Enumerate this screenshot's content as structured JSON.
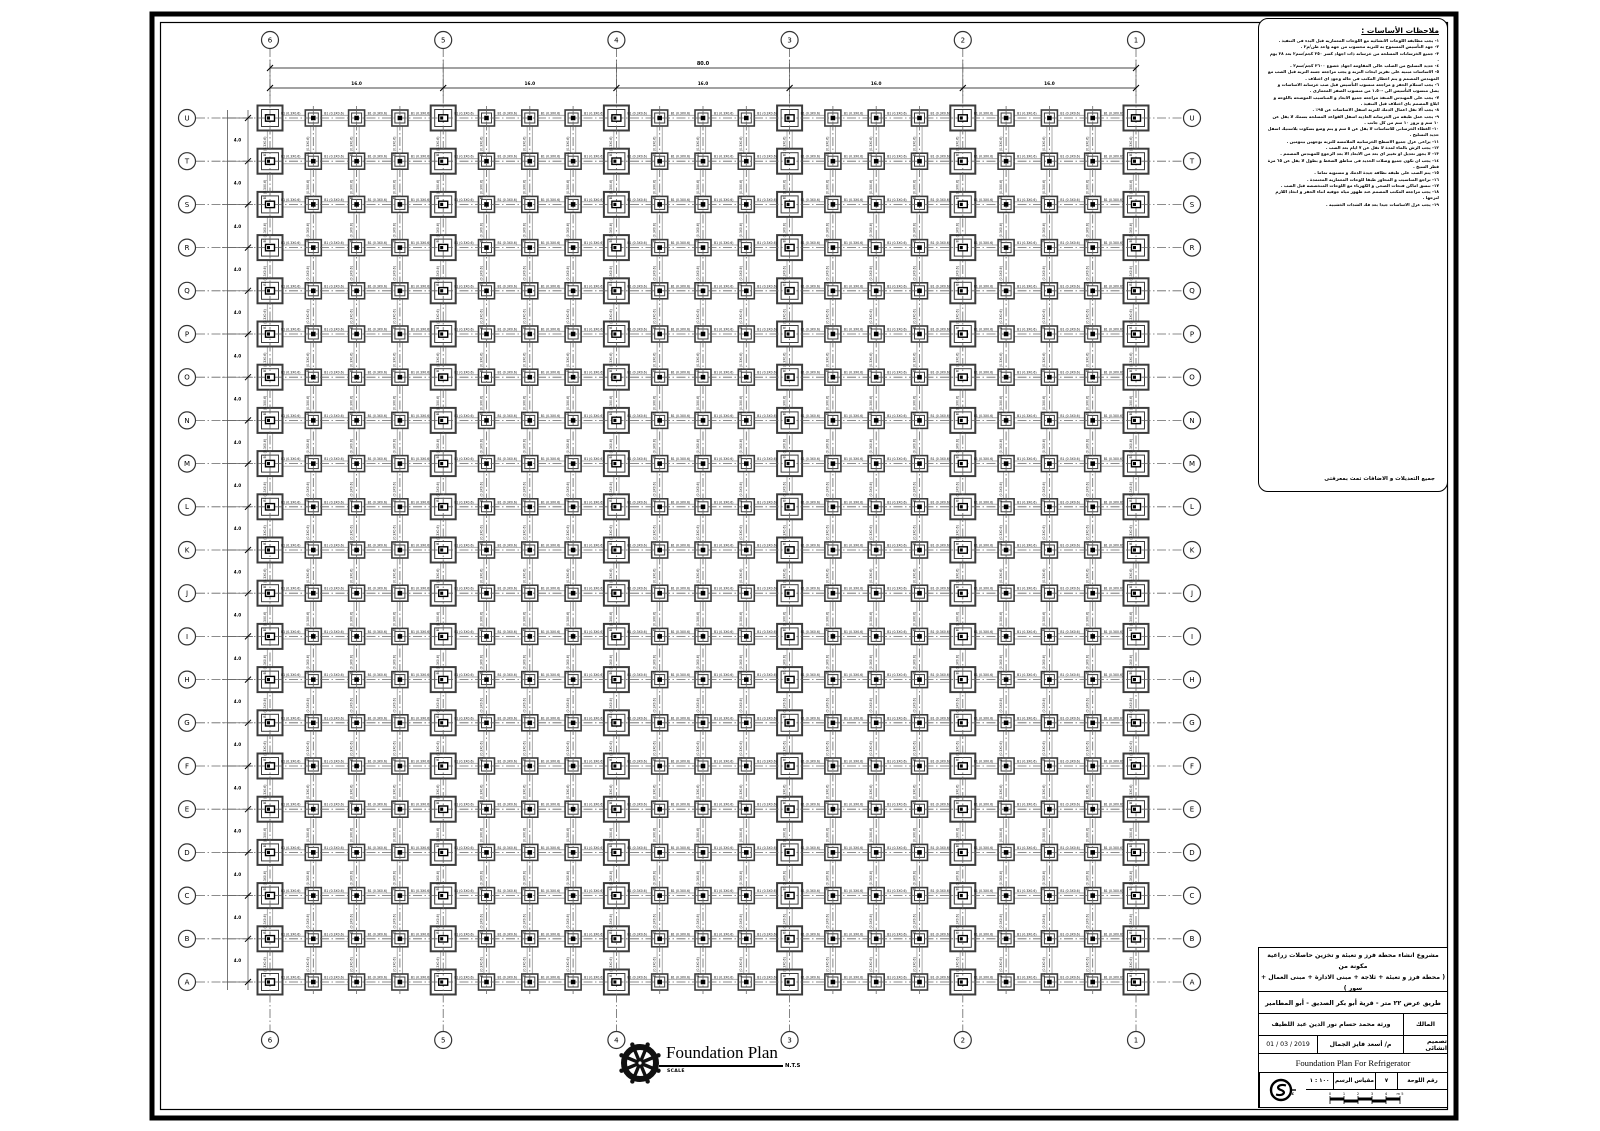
{
  "plan": {
    "column_labels": [
      "6",
      "5",
      "4",
      "3",
      "2",
      "1"
    ],
    "row_labels": [
      "U",
      "T",
      "S",
      "R",
      "Q",
      "P",
      "O",
      "N",
      "M",
      "L",
      "K",
      "J",
      "I",
      "H",
      "G",
      "F",
      "E",
      "D",
      "C",
      "B",
      "A"
    ],
    "beam_label": "B1 (0.3X0.6)",
    "dimensions": {
      "overall": "80.0",
      "bays": [
        "16.0",
        "16.0",
        "16.0",
        "16.0",
        "16.0"
      ],
      "row_spacing": "4.0"
    }
  },
  "plan_caption": {
    "title": "Foundation Plan",
    "scale_label": "SCALE",
    "scale_value": "N.T.S"
  },
  "notes": {
    "title": "ملاحظات الأساسات :",
    "lines": [
      "١- يجب مطابقة اللوحات الانشائية مع اللوحات المعمارية قبل البدء فى التنفيذ .",
      "٢- جهد التأسيس المسموح به للتربة محسوب من جهة واحد طن/م٢ .",
      "٣- جميع الخرسانات المسلحة من خرسانة ذات اجهاد كسر ٢٥٠ كجم/سم٢ بعد ٢٨ يوم .",
      "٤- حديد التسليح من الصلب عالى المقاومة اجهاد خضوع ٣٦٠٠ كجم/سم٢ .",
      "٥- الاساسات مبنية على تقرير ابحاث التربة و يجب مراجعة جسة التربة قبل الصب مع المهندس المصمم و يتم اخطار المكتب فى حالة وجود اى اختلاف .",
      "٦- يجب استلام الحفر و مراجعة منسوب التأسيس قبل صب خرسانة الاساسات و يصل منسوب التأسيس الى -١.٥٠ من منسوب الصفر المعمارى .",
      "٧- يجب على المهندس المنفذ مراجعة جميع الابعاد و المناسيب الموضحة باللوحة و ابلاغ المصمم باى اختلاف قبل التنفيذ .",
      "٨- يجب ألا تقل اعمال الدمك للتربة اسفل الاساسات عن ٩٥٪ .",
      "٩- يجب عمل طبقة من الخرسانة العادية اسفل القواعد المسلحة بسمك لا يقل عن ١٠ سم و بروز ١٠ سم من كل جانب .",
      "١٠- الغطاء الخرسانى للاساسات لا يقل عن ٥ سم و يتم وضع بسكوت بلاستيك اسفل حديد التسليح .",
      "١١- يراعى عزل جميع الاسطح الخرسانية الملامسة للتربة بوجهين بيتومين .",
      "١٢- يجب الرش بالماء لمدة لا تقل عن ٧ ايام بعد الصب .",
      "١٣- لا يجوز تعديل او تغيير اى بعد من الابعاد الا بعد الرجوع للمهندس المصمم .",
      "١٤- يجب ان تكون جميع وصلات الحديد فى مناطق الضغط و بطول لا يقل عن ٦٥ مرة قطر السيخ .",
      "١٥- يتم الصب على طبقة نظافة جيدة الدمك و مستوية تماما .",
      "١٦- تراجع المناسيب و المحاور طبقا للوحات المعمارية المعتمدة .",
      "١٧- تنسق اماكن فتحات الصحى و الكهرباء مع اللوحات المتخصصة قبل الصب .",
      "١٨- يجب مراجعة المكتب المصمم عند ظهور مياه جوفية اثناء الحفر و اتخاذ اللازم لنزحها .",
      "١٩- يجب عزل الاساسات جيدا بعد فك الشدات الخشبية ."
    ],
    "footer": "جميع التعديلات و الاضافات تمت بمعرفتى"
  },
  "title_block": {
    "project": [
      "مشروع انشاء محطة فرز و تعبئة و تخزين حاصلات زراعية",
      "مكونة من",
      "( محطة فرز و تعبئة + ثلاجة + مبنى الادارة + مبنى العمال + سور )"
    ],
    "location": "طريق عرض ٢٢ متر - قرية أبو بكر الصديق - أبو المطامير",
    "owner_label": "المالك",
    "owner_value": "ورثة محمد حسام نور الدين عبد اللطيف",
    "designer_label": "تصميم انشائى",
    "designer_value": "م/ أسعد فايز الجمال",
    "date": "01 / 03 / 2019",
    "drawing_title_en": "Foundation Plan For Refrigerator",
    "sheet_no_label": "رقم اللوحة",
    "sheet_no": "٧",
    "scale_label": "مقياس الرسم",
    "scale_value": "١٠٠ : ١",
    "scale_bar_ticks": [
      "0",
      "1",
      "2",
      "3",
      "4",
      "5 m"
    ]
  },
  "colors": {
    "ink": "#000000",
    "beam": "#adadad",
    "footing": "#3c3c3c",
    "centerline": "#666666",
    "paper": "#ffffff"
  }
}
